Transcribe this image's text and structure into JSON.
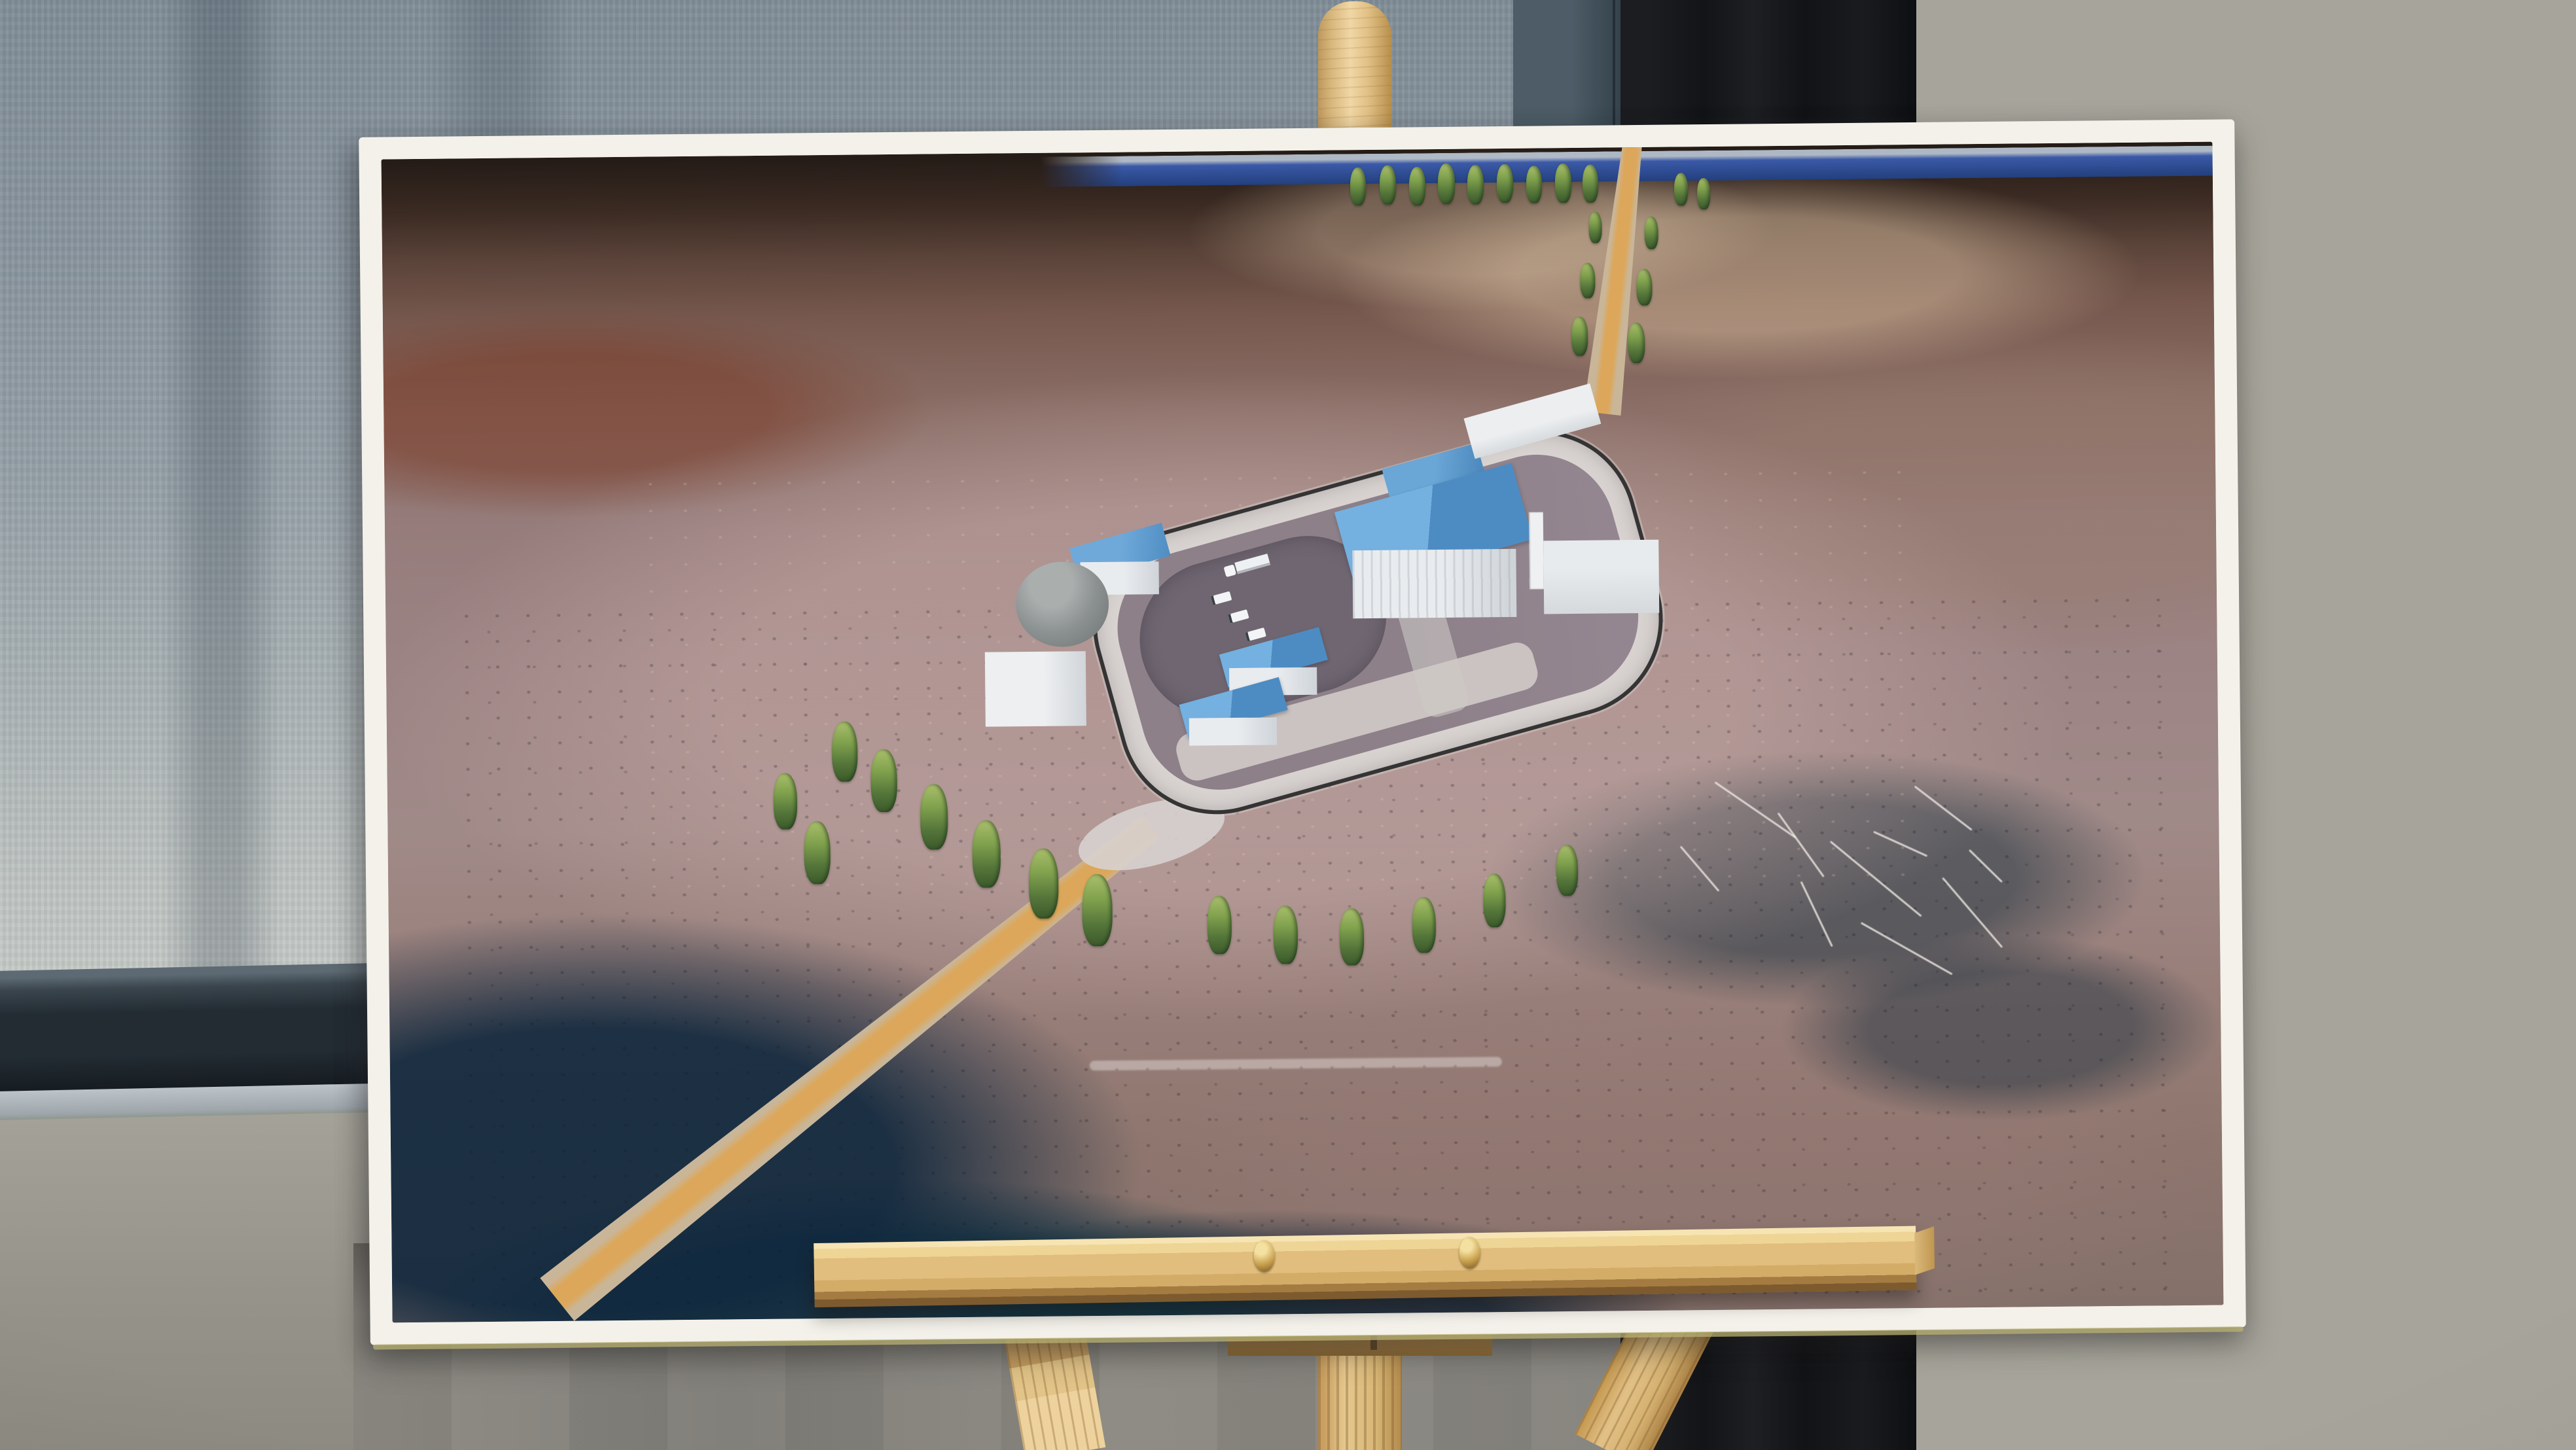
{
  "scene": {
    "kind": "photograph",
    "description": "Large printed aerial architectural rendering of a fenced outback facility, mounted on a foam board and displayed on a light pine easel indoors",
    "background": {
      "left": "blue-grey fabric window blind with dark bottom rail and sill",
      "center": "dark teal wall panel and near-black wall panel",
      "right": "warm grey wall panels with one horizontal seam",
      "lower": "warm grey wall behind easel legs"
    }
  },
  "palette": {
    "blind": "#8b97a0",
    "blind_rail": "#232c33",
    "slate_panel": "#47565f",
    "black_panel": "#141518",
    "wall_right": "#a7a59b",
    "wall_low": "#8a8880",
    "poster_border": "#f3f1ea",
    "easel_wood": "#e0bd7c",
    "brass_screw": "#caa24f",
    "terrain_plain": "#9c8484",
    "terrain_dark": "#2e2420",
    "scrub": "#1c3a52",
    "ocean": "#2a4a96",
    "ring_road": "#d8d3d0",
    "compound_ground": "#8d8089",
    "roof_blue": "#5d9bcd",
    "building_white": "#e9ecef",
    "access_road": "#dca75a",
    "tree_green": "#80a14d"
  },
  "poster": {
    "border": "white margin all around, slight drop shadow, yellowish board edge at bottom",
    "render": {
      "horizon": "dark blue sea strip across the top right",
      "facility": {
        "shape": "elongated rounded-rectangle compound rotated toward upper right",
        "fence": "black perimeter security fence",
        "ring_road": "light grey perimeter road",
        "interior": [
          "large dark oval pad on the west half",
          "light parking strip along the south side"
        ],
        "buildings": [
          {
            "name": "main-processing-building",
            "walls": "white ribbed",
            "roof": "large blue gable",
            "features": [
              "tall white stack",
              "small stack",
              "white annex east",
              "blue roofed section behind"
            ]
          },
          {
            "name": "long-white-building-north",
            "walls": "white",
            "roof": "white"
          },
          {
            "name": "west-blue-roof-building",
            "walls": "white",
            "roof": "blue"
          },
          {
            "name": "grey-storage-tank",
            "shape": "cylinder"
          },
          {
            "name": "west-white-shed"
          },
          {
            "name": "south-blue-shed-1",
            "roof": "blue"
          },
          {
            "name": "south-blue-shed-2",
            "roof": "blue"
          }
        ],
        "vehicles": [
          "white semi-trailer truck",
          "three white utility trucks"
        ]
      },
      "roads": [
        "sandy access road with orange centre entering from bottom left",
        "tree-lined sandy road exiting top right to the horizon"
      ],
      "terrain": [
        "dark brown hills along the top",
        "mauve-pink cleared plains",
        "dark blue-green scrub patches bottom left, bottom centre and mid right",
        "pale scratch marks in scrub on the right"
      ],
      "watermark": "faint illegible white caption line near bottom centre",
      "trees": [
        [
          1480,
          27,
          58
        ],
        [
          1525,
          24,
          60
        ],
        [
          1570,
          27,
          59
        ],
        [
          1614,
          22,
          62
        ],
        [
          1659,
          25,
          60
        ],
        [
          1704,
          24,
          59
        ],
        [
          1749,
          27,
          57
        ],
        [
          1793,
          24,
          60
        ],
        [
          1835,
          26,
          58
        ],
        [
          1975,
          40,
          50
        ],
        [
          2010,
          48,
          48
        ],
        [
          1902,
          268,
          62
        ],
        [
          1916,
          186,
          56
        ],
        [
          1929,
          106,
          50
        ],
        [
          1816,
          258,
          60
        ],
        [
          1830,
          176,
          54
        ],
        [
          1844,
          98,
          48
        ],
        [
          680,
          866,
          92
        ],
        [
          739,
          909,
          96
        ],
        [
          814,
          963,
          100
        ],
        [
          893,
          1019,
          103
        ],
        [
          979,
          1063,
          107
        ],
        [
          1060,
          1103,
          110
        ],
        [
          636,
          1018,
          96
        ],
        [
          590,
          944,
          86
        ],
        [
          1251,
          1138,
          89
        ],
        [
          1352,
          1154,
          89
        ],
        [
          1453,
          1159,
          87
        ],
        [
          1564,
          1143,
          85
        ],
        [
          1673,
          1108,
          82
        ],
        [
          1785,
          1065,
          78
        ]
      ],
      "scratches": [
        [
          2015,
          1013,
          150,
          35
        ],
        [
          2099,
          1067,
          120,
          55
        ],
        [
          2183,
          1120,
          180,
          40
        ],
        [
          2266,
          1067,
          90,
          25
        ],
        [
          2350,
          1173,
          140,
          50
        ],
        [
          2127,
          1173,
          110,
          65
        ],
        [
          2239,
          1227,
          160,
          30
        ],
        [
          2406,
          1102,
          70,
          45
        ],
        [
          1959,
          1102,
          90,
          50
        ],
        [
          2322,
          1013,
          110,
          38
        ]
      ]
    }
  },
  "easel": {
    "material": "light pine",
    "parts": [
      "rounded top post above the board",
      "wide tray ledge with two brass screws",
      "left front leg",
      "fluted centre post",
      "angled right leg",
      "support block under tray"
    ]
  }
}
